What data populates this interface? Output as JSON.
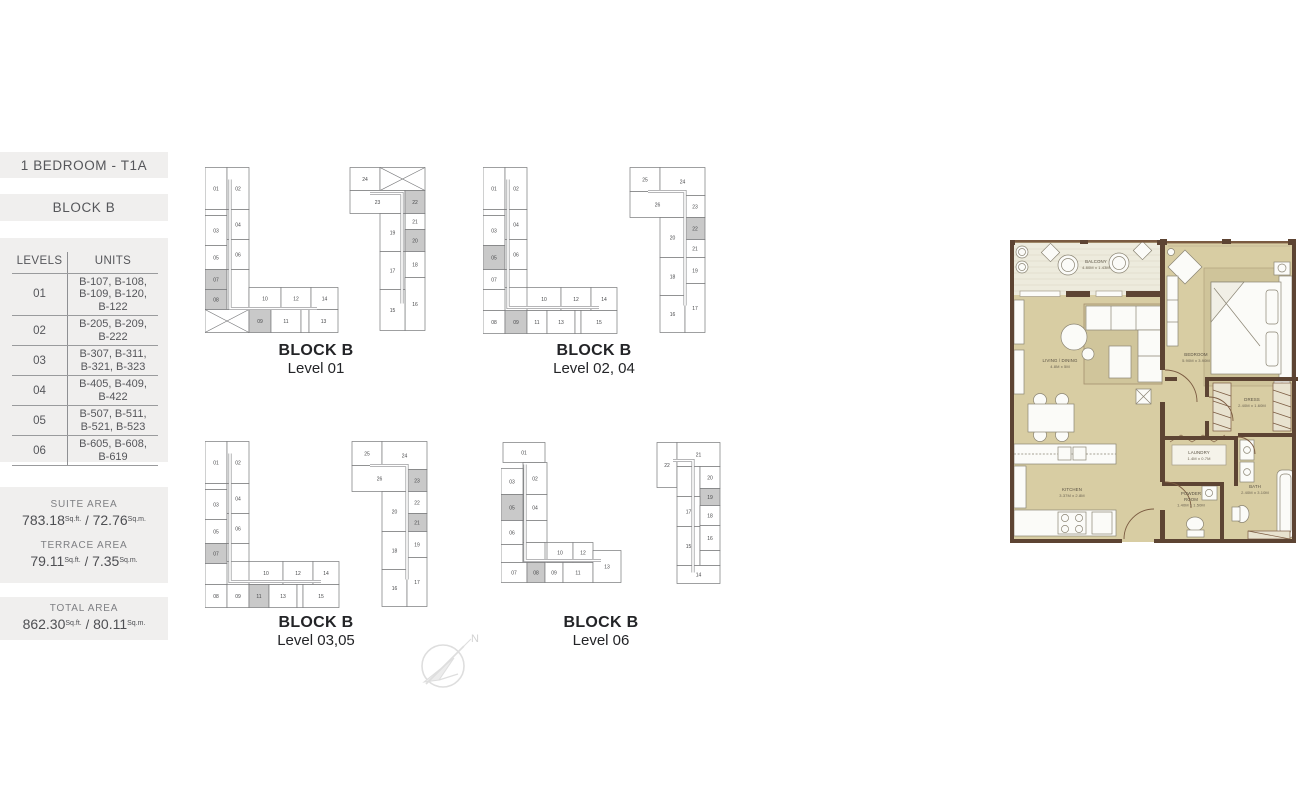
{
  "sidebar": {
    "type_title": "1 BEDROOM - T1A",
    "block_title": "BLOCK B",
    "table": {
      "headers": [
        "LEVELS",
        "UNITS"
      ],
      "rows": [
        {
          "level": "01",
          "units": "B-107, B-108,\nB-109, B-120,\nB-122"
        },
        {
          "level": "02",
          "units": "B-205, B-209,\nB-222"
        },
        {
          "level": "03",
          "units": "B-307, B-311,\nB-321, B-323"
        },
        {
          "level": "04",
          "units": "B-405, B-409,\nB-422"
        },
        {
          "level": "05",
          "units": "B-507, B-511,\nB-521, B-523"
        },
        {
          "level": "06",
          "units": "B-605, B-608,\nB-619"
        }
      ]
    },
    "area_separator": "/",
    "areas": [
      {
        "label": "SUITE AREA",
        "ft": "783.18",
        "ft_unit": "Sq.ft.",
        "m": "72.76",
        "m_unit": "Sq.m."
      },
      {
        "label": "TERRACE AREA",
        "ft": "79.11",
        "ft_unit": "Sq.ft.",
        "m": "7.35",
        "m_unit": "Sq.m."
      },
      {
        "label": "TOTAL AREA",
        "ft": "862.30",
        "ft_unit": "Sq.ft.",
        "m": "80.11",
        "m_unit": "Sq.m."
      }
    ]
  },
  "diagram_style": {
    "highlight": "#c9c9c9",
    "cell_fill": "#ffffff",
    "stroke": "#77787a"
  },
  "diagrams": [
    {
      "caption1": "BLOCK B",
      "caption2": "Level 01",
      "buildings": [
        {
          "dx": 0,
          "corridor": "M25,12 L25,141 L112,141",
          "cells": [
            [
              "01",
              0,
              0,
              22,
              42,
              "n"
            ],
            [
              "02",
              22,
              0,
              22,
              42,
              "n"
            ],
            [
              "",
              0,
              42,
              22,
              6,
              "e"
            ],
            [
              "03",
              0,
              48,
              22,
              30,
              "n"
            ],
            [
              "04",
              22,
              42,
              22,
              30,
              "n"
            ],
            [
              "05",
              0,
              78,
              22,
              24,
              "n"
            ],
            [
              "06",
              22,
              72,
              22,
              30,
              "n"
            ],
            [
              "07",
              0,
              102,
              22,
              20,
              "h"
            ],
            [
              "08",
              0,
              122,
              22,
              20,
              "h"
            ],
            [
              "",
              22,
              102,
              22,
              40,
              "e"
            ],
            [
              "",
              0,
              142,
              44,
              23,
              "x"
            ],
            [
              "10",
              44,
              120,
              32,
              22,
              "n"
            ],
            [
              "12",
              76,
              120,
              30,
              22,
              "n"
            ],
            [
              "14",
              106,
              120,
              27,
              22,
              "n"
            ],
            [
              "09",
              44,
              142,
              22,
              23,
              "h"
            ],
            [
              "11",
              66,
              142,
              30,
              23,
              "n"
            ],
            [
              "",
              96,
              142,
              8,
              23,
              "e"
            ],
            [
              "13",
              104,
              142,
              29,
              23,
              "n"
            ]
          ]
        },
        {
          "dx": 145,
          "corridor": "M20,26 L52,26 L52,136",
          "cells": [
            [
              "24",
              0,
              0,
              30,
              23,
              "n"
            ],
            [
              "",
              30,
              0,
              45,
              23,
              "x"
            ],
            [
              "23",
              0,
              23,
              55,
              23,
              "n"
            ],
            [
              "22",
              55,
              23,
              20,
              23,
              "h"
            ],
            [
              "21",
              55,
              46,
              20,
              16,
              "n"
            ],
            [
              "19",
              30,
              46,
              25,
              38,
              "n"
            ],
            [
              "20",
              55,
              62,
              20,
              22,
              "h"
            ],
            [
              "18",
              55,
              84,
              20,
              26,
              "n"
            ],
            [
              "17",
              30,
              84,
              25,
              38,
              "n"
            ],
            [
              "16",
              55,
              110,
              20,
              53,
              "n"
            ],
            [
              "15",
              30,
              122,
              25,
              41,
              "n"
            ]
          ]
        }
      ]
    },
    {
      "caption1": "BLOCK B",
      "caption2": "Level 02, 04",
      "buildings": [
        {
          "dx": 0,
          "corridor": "M25,12 L25,140 L116,140",
          "cells": [
            [
              "01",
              0,
              0,
              22,
              42,
              "n"
            ],
            [
              "02",
              22,
              0,
              22,
              42,
              "n"
            ],
            [
              "",
              0,
              42,
              22,
              6,
              "e"
            ],
            [
              "03",
              0,
              48,
              22,
              30,
              "n"
            ],
            [
              "04",
              22,
              42,
              22,
              30,
              "n"
            ],
            [
              "05",
              0,
              78,
              22,
              24,
              "h"
            ],
            [
              "06",
              22,
              72,
              22,
              30,
              "n"
            ],
            [
              "07",
              0,
              102,
              22,
              20,
              "n"
            ],
            [
              "",
              0,
              122,
              22,
              21,
              "e"
            ],
            [
              "",
              22,
              102,
              22,
              18,
              "e"
            ],
            [
              "08",
              0,
              143,
              22,
              23,
              "n"
            ],
            [
              "10",
              44,
              120,
              34,
              23,
              "n"
            ],
            [
              "12",
              78,
              120,
              30,
              23,
              "n"
            ],
            [
              "14",
              108,
              120,
              26,
              23,
              "n"
            ],
            [
              "09",
              22,
              143,
              22,
              23,
              "h"
            ],
            [
              "11",
              44,
              143,
              20,
              23,
              "n"
            ],
            [
              "13",
              64,
              143,
              28,
              23,
              "n"
            ],
            [
              "",
              92,
              143,
              6,
              23,
              "e"
            ],
            [
              "15",
              98,
              143,
              36,
              23,
              "n"
            ]
          ]
        },
        {
          "dx": 147,
          "corridor": "M18,24 L55,24 L55,138",
          "cells": [
            [
              "25",
              0,
              0,
              30,
              24,
              "n"
            ],
            [
              "24",
              30,
              0,
              45,
              28,
              "n"
            ],
            [
              "26",
              0,
              24,
              55,
              26,
              "n"
            ],
            [
              "23",
              55,
              28,
              20,
              22,
              "n"
            ],
            [
              "22",
              55,
              50,
              20,
              22,
              "h"
            ],
            [
              "20",
              30,
              50,
              25,
              40,
              "n"
            ],
            [
              "21",
              55,
              72,
              20,
              18,
              "n"
            ],
            [
              "18",
              30,
              90,
              25,
              38,
              "n"
            ],
            [
              "19",
              55,
              90,
              20,
              26,
              "n"
            ],
            [
              "16",
              30,
              128,
              25,
              37,
              "n"
            ],
            [
              "17",
              55,
              116,
              20,
              49,
              "n"
            ]
          ]
        }
      ]
    },
    {
      "caption1": "BLOCK B",
      "caption2": "Level 03,05",
      "buildings": [
        {
          "dx": 0,
          "corridor": "M25,12 L25,140 L116,140",
          "cells": [
            [
              "01",
              0,
              0,
              22,
              42,
              "n"
            ],
            [
              "02",
              22,
              0,
              22,
              42,
              "n"
            ],
            [
              "",
              0,
              42,
              22,
              6,
              "e"
            ],
            [
              "03",
              0,
              48,
              22,
              30,
              "n"
            ],
            [
              "04",
              22,
              42,
              22,
              30,
              "n"
            ],
            [
              "05",
              0,
              78,
              22,
              24,
              "n"
            ],
            [
              "06",
              22,
              72,
              22,
              30,
              "n"
            ],
            [
              "07",
              0,
              102,
              22,
              20,
              "h"
            ],
            [
              "",
              0,
              122,
              22,
              21,
              "e"
            ],
            [
              "",
              22,
              102,
              22,
              18,
              "e"
            ],
            [
              "08",
              0,
              143,
              22,
              23,
              "n"
            ],
            [
              "10",
              44,
              120,
              34,
              23,
              "n"
            ],
            [
              "12",
              78,
              120,
              30,
              23,
              "n"
            ],
            [
              "14",
              108,
              120,
              26,
              23,
              "n"
            ],
            [
              "09",
              22,
              143,
              22,
              23,
              "n"
            ],
            [
              "11",
              44,
              143,
              20,
              23,
              "h"
            ],
            [
              "13",
              64,
              143,
              28,
              23,
              "n"
            ],
            [
              "",
              92,
              143,
              6,
              23,
              "e"
            ],
            [
              "15",
              98,
              143,
              36,
              23,
              "n"
            ]
          ]
        },
        {
          "dx": 147,
          "corridor": "M18,24 L55,24 L55,138",
          "cells": [
            [
              "25",
              0,
              0,
              30,
              24,
              "n"
            ],
            [
              "24",
              30,
              0,
              45,
              28,
              "n"
            ],
            [
              "26",
              0,
              24,
              55,
              26,
              "n"
            ],
            [
              "23",
              55,
              28,
              20,
              22,
              "h"
            ],
            [
              "22",
              55,
              50,
              20,
              22,
              "n"
            ],
            [
              "20",
              30,
              50,
              25,
              40,
              "n"
            ],
            [
              "21",
              55,
              72,
              20,
              18,
              "h"
            ],
            [
              "18",
              30,
              90,
              25,
              38,
              "n"
            ],
            [
              "19",
              55,
              90,
              20,
              26,
              "n"
            ],
            [
              "16",
              30,
              128,
              25,
              37,
              "n"
            ],
            [
              "17",
              55,
              116,
              20,
              49,
              "n"
            ]
          ]
        }
      ]
    },
    {
      "caption1": "BLOCK B",
      "caption2": "Level 06",
      "buildings": [
        {
          "dx": 0,
          "corridor": "M24,22 L24,118 L100,118",
          "cells": [
            [
              "01",
              2,
              0,
              42,
              20,
              "n"
            ],
            [
              "02",
              22,
              20,
              24,
              32,
              "n"
            ],
            [
              "03",
              0,
              26,
              22,
              26,
              "n"
            ],
            [
              "04",
              22,
              52,
              24,
              26,
              "n"
            ],
            [
              "05",
              0,
              52,
              22,
              26,
              "h"
            ],
            [
              "06",
              0,
              78,
              22,
              24,
              "n"
            ],
            [
              "",
              22,
              78,
              24,
              22,
              "e"
            ],
            [
              "",
              0,
              102,
              22,
              18,
              "e"
            ],
            [
              "",
              22,
              100,
              22,
              20,
              "e"
            ],
            [
              "10",
              46,
              100,
              26,
              20,
              "n"
            ],
            [
              "12",
              72,
              100,
              20,
              20,
              "n"
            ],
            [
              "07",
              0,
              120,
              26,
              20,
              "n"
            ],
            [
              "08",
              26,
              120,
              18,
              20,
              "h"
            ],
            [
              "09",
              44,
              120,
              18,
              20,
              "n"
            ],
            [
              "11",
              62,
              120,
              30,
              20,
              "n"
            ],
            [
              "13",
              92,
              108,
              28,
              32,
              "n"
            ]
          ]
        },
        {
          "dx": 156,
          "corridor": "M16,18 L36,18 L36,130",
          "cells": [
            [
              "22",
              0,
              0,
              20,
              45,
              "n"
            ],
            [
              "21",
              20,
              0,
              43,
              24,
              "n"
            ],
            [
              "",
              20,
              24,
              23,
              30,
              "e"
            ],
            [
              "20",
              43,
              24,
              20,
              22,
              "n"
            ],
            [
              "19",
              43,
              46,
              20,
              17,
              "h"
            ],
            [
              "17",
              20,
              54,
              23,
              30,
              "n"
            ],
            [
              "18",
              43,
              63,
              20,
              20,
              "n"
            ],
            [
              "15",
              20,
              84,
              23,
              39,
              "n"
            ],
            [
              "16",
              43,
              83,
              20,
              25,
              "n"
            ],
            [
              "",
              43,
              108,
              20,
              15,
              "e"
            ],
            [
              "14",
              20,
              123,
              43,
              18,
              "n"
            ]
          ]
        }
      ]
    }
  ],
  "compass": {
    "north_label": "N"
  },
  "floor_plan": {
    "rooms": [
      {
        "lines": [
          "BALCONY",
          "4.80M x 1.43M"
        ],
        "x": 88,
        "y": 25
      },
      {
        "lines": [
          "LIVING / DINING",
          "4.8M x 5M"
        ],
        "x": 52,
        "y": 124
      },
      {
        "lines": [
          "BEDROOM",
          "5.90M x 3.90M"
        ],
        "x": 188,
        "y": 118
      },
      {
        "lines": [
          "KITCHEN",
          "3.37M x 2.8M"
        ],
        "x": 64,
        "y": 253
      },
      {
        "lines": [
          "DRESS",
          "2.40M x 1.60M"
        ],
        "x": 244,
        "y": 163
      },
      {
        "lines": [
          "LAUNDRY",
          "1.4M x 0.7M"
        ],
        "x": 191,
        "y": 216
      },
      {
        "lines": [
          "POWDER",
          "ROOM",
          "1.40M x 1.50M"
        ],
        "x": 183,
        "y": 257
      },
      {
        "lines": [
          "BATH",
          "2.40M x 3.10M"
        ],
        "x": 247,
        "y": 250
      }
    ]
  }
}
